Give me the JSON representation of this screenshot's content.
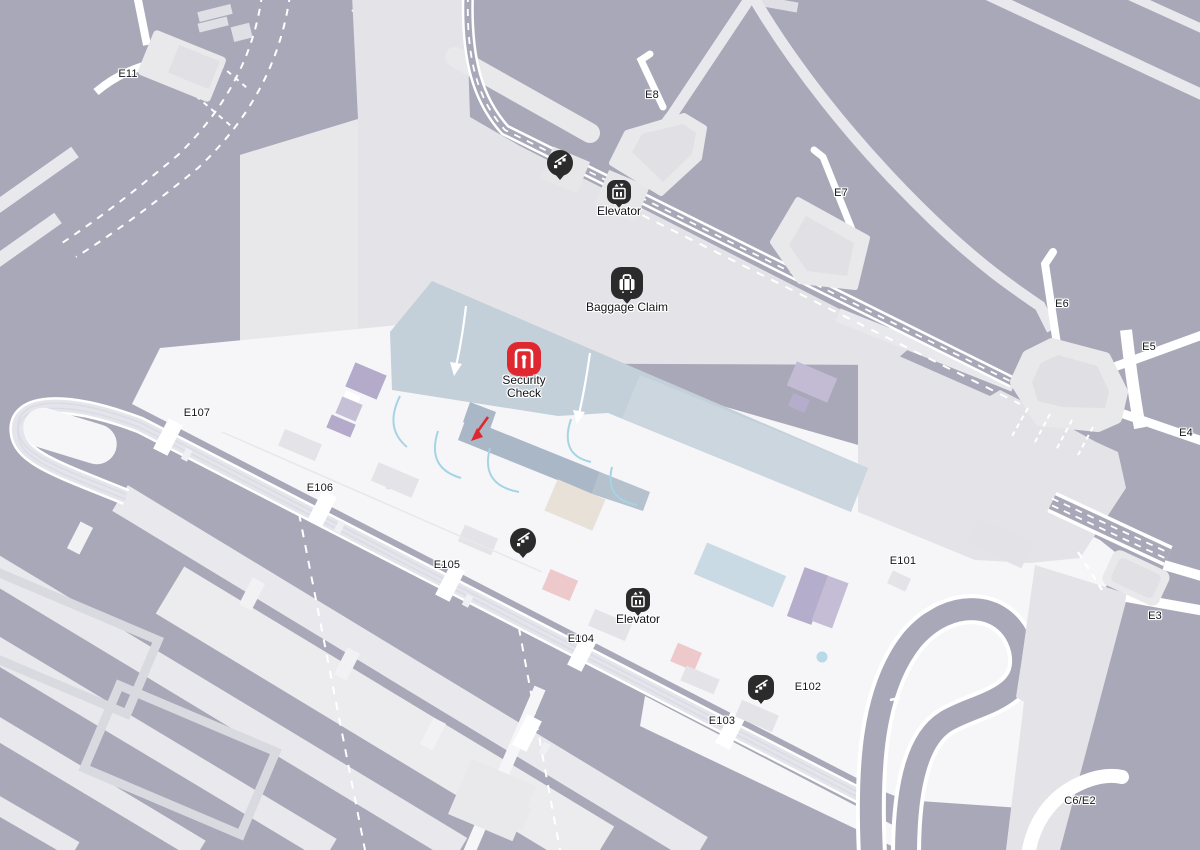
{
  "map": {
    "gates": [
      {
        "id": "e11",
        "label": "E11"
      },
      {
        "id": "e8",
        "label": "E8"
      },
      {
        "id": "e7",
        "label": "E7"
      },
      {
        "id": "e6",
        "label": "E6"
      },
      {
        "id": "e5",
        "label": "E5"
      },
      {
        "id": "e4",
        "label": "E4"
      },
      {
        "id": "e3",
        "label": "E3"
      },
      {
        "id": "c6-e2",
        "label": "C6/E2"
      },
      {
        "id": "e101",
        "label": "E101"
      },
      {
        "id": "e102",
        "label": "E102"
      },
      {
        "id": "e103",
        "label": "E103"
      },
      {
        "id": "e104",
        "label": "E104"
      },
      {
        "id": "e105",
        "label": "E105"
      },
      {
        "id": "e106",
        "label": "E106"
      },
      {
        "id": "e107",
        "label": "E107"
      }
    ],
    "pois": [
      {
        "id": "escalator-upper",
        "type": "escalator",
        "label": ""
      },
      {
        "id": "elevator-upper",
        "type": "elevator",
        "label": "Elevator"
      },
      {
        "id": "baggage-claim",
        "type": "baggage-claim",
        "label": "Baggage Claim"
      },
      {
        "id": "security-check",
        "type": "security-check",
        "label": "Security Check"
      },
      {
        "id": "escalator-mid",
        "type": "escalator",
        "label": ""
      },
      {
        "id": "elevator-lower",
        "type": "elevator",
        "label": "Elevator"
      },
      {
        "id": "escalator-e102",
        "type": "escalator",
        "label": ""
      }
    ],
    "colors": {
      "background": "#a8a8b8",
      "terminal": "#e4e4e8",
      "concourse": "#f6f6f8",
      "road": "#e9e9ed",
      "security_zone": "#c3d0da",
      "walkway": "#a9b7c7",
      "queue_line": "#a5d4e4",
      "poi_black": "#2b2b2b",
      "security_red": "#df2730",
      "purple_area": "#b5adcc",
      "pink_area": "#edc9cc",
      "blue_area": "#c9dae4"
    }
  }
}
